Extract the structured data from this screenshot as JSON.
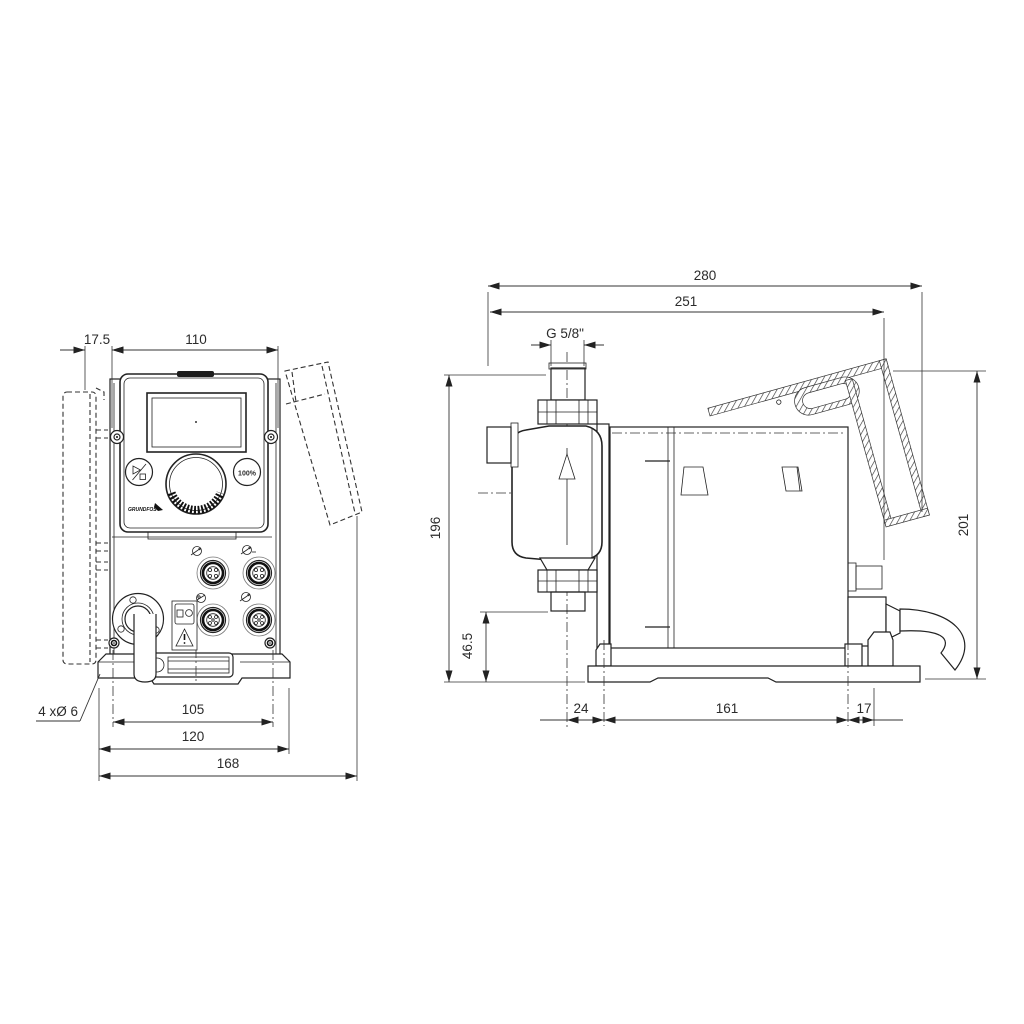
{
  "drawing": {
    "front_view": {
      "dim_plate_offset": "17.5",
      "dim_panel_width": "110",
      "dim_hole_spacing": "105",
      "dim_flange_width": "120",
      "dim_total_width": "168",
      "mounting_holes_callout": "4 xØ 6",
      "panel": {
        "capacity_button_label": "100%",
        "brand_logo": "GRUNDFOS"
      }
    },
    "side_view": {
      "dim_total_depth": "280",
      "dim_mounting_depth": "251",
      "dim_connection_thread": "G 5/8\"",
      "dim_height_valve_top": "196",
      "dim_height_valve_bottom": "46.5",
      "dim_foot_offset": "24",
      "dim_foot_spacing": "161",
      "dim_foot_to_edge": "17",
      "dim_total_height": "201"
    },
    "colors": {
      "line": "#222222",
      "dimension_text": "#2b2b2b",
      "background": "#ffffff"
    }
  }
}
